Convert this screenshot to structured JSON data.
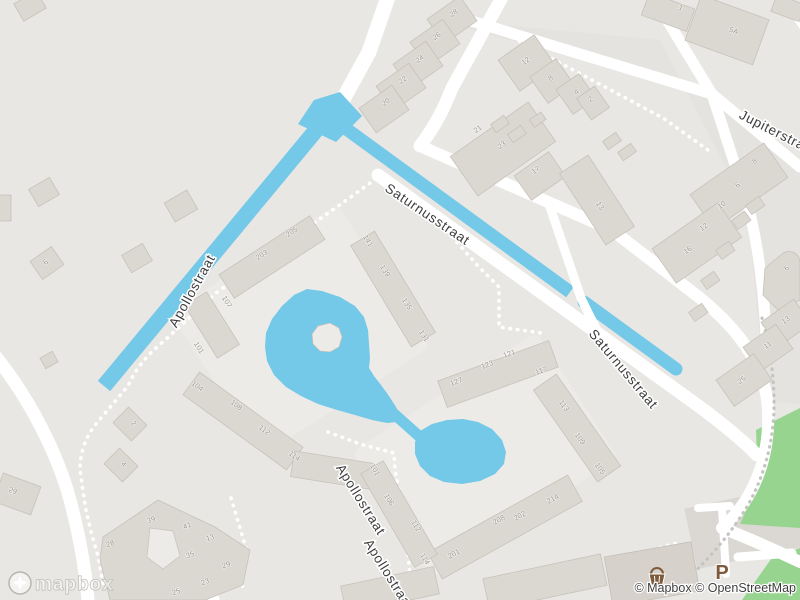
{
  "map": {
    "street_labels": [
      {
        "text": "Saturnusstraat",
        "x": 425,
        "y": 218,
        "r": 34
      },
      {
        "text": "Saturnusstraat",
        "x": 620,
        "y": 372,
        "r": 50
      },
      {
        "text": "Jupiterstraat",
        "x": 776,
        "y": 137,
        "r": 27
      },
      {
        "text": "Apollostraat",
        "x": 196,
        "y": 293,
        "r": -61
      },
      {
        "text": "Apollostraat",
        "x": 357,
        "y": 502,
        "r": 58
      },
      {
        "text": "Apollostraat",
        "x": 385,
        "y": 577,
        "r": 58
      }
    ],
    "house_numbers": [
      {
        "t": "28",
        "x": 455,
        "y": 15,
        "r": -35
      },
      {
        "t": "26",
        "x": 438,
        "y": 38,
        "r": -35
      },
      {
        "t": "24",
        "x": 421,
        "y": 61,
        "r": -35
      },
      {
        "t": "22",
        "x": 404,
        "y": 82,
        "r": -35
      },
      {
        "t": "20",
        "x": 387,
        "y": 104,
        "r": -35
      },
      {
        "t": "12",
        "x": 527,
        "y": 63,
        "r": -35
      },
      {
        "t": "8",
        "x": 552,
        "y": 80,
        "r": -35
      },
      {
        "t": "4",
        "x": 578,
        "y": 94,
        "r": -35
      },
      {
        "t": "2",
        "x": 592,
        "y": 101,
        "r": -35
      },
      {
        "t": "21",
        "x": 479,
        "y": 131,
        "r": -35
      },
      {
        "t": "23",
        "x": 503,
        "y": 147,
        "r": -35
      },
      {
        "t": "17",
        "x": 537,
        "y": 172,
        "r": -35
      },
      {
        "t": "1",
        "x": 680,
        "y": 10,
        "r": 20
      },
      {
        "t": "5A",
        "x": 733,
        "y": 33,
        "r": 20
      },
      {
        "t": "8",
        "x": 756,
        "y": 163,
        "r": -35
      },
      {
        "t": "6",
        "x": 739,
        "y": 187,
        "r": -35
      },
      {
        "t": "10",
        "x": 723,
        "y": 207,
        "r": -35
      },
      {
        "t": "12",
        "x": 705,
        "y": 229,
        "r": -35
      },
      {
        "t": "16",
        "x": 689,
        "y": 252,
        "r": -35
      },
      {
        "t": "6",
        "x": 788,
        "y": 270,
        "r": -35
      },
      {
        "t": "13",
        "x": 787,
        "y": 322,
        "r": -35
      },
      {
        "t": "11",
        "x": 769,
        "y": 347,
        "r": -35
      },
      {
        "t": "25",
        "x": 743,
        "y": 382,
        "r": -35
      },
      {
        "t": "13",
        "x": 598,
        "y": 207,
        "r": 57
      },
      {
        "t": "203",
        "x": 263,
        "y": 257,
        "r": -33
      },
      {
        "t": "205",
        "x": 293,
        "y": 234,
        "r": -33
      },
      {
        "t": "141",
        "x": 366,
        "y": 242,
        "r": 59
      },
      {
        "t": "139",
        "x": 383,
        "y": 272,
        "r": 59
      },
      {
        "t": "135",
        "x": 405,
        "y": 305,
        "r": 59
      },
      {
        "t": "131",
        "x": 422,
        "y": 337,
        "r": 59
      },
      {
        "t": "107",
        "x": 225,
        "y": 303,
        "r": 58
      },
      {
        "t": "101",
        "x": 197,
        "y": 349,
        "r": 58
      },
      {
        "t": "104",
        "x": 196,
        "y": 388,
        "r": 36
      },
      {
        "t": "108",
        "x": 235,
        "y": 407,
        "r": 36
      },
      {
        "t": "112",
        "x": 263,
        "y": 432,
        "r": 36
      },
      {
        "t": "114",
        "x": 293,
        "y": 458,
        "r": 36
      },
      {
        "t": "127",
        "x": 457,
        "y": 384,
        "r": -20
      },
      {
        "t": "123",
        "x": 488,
        "y": 367,
        "r": -20
      },
      {
        "t": "121",
        "x": 510,
        "y": 356,
        "r": -20
      },
      {
        "t": "117",
        "x": 542,
        "y": 373,
        "r": -20
      },
      {
        "t": "113",
        "x": 562,
        "y": 407,
        "r": 55
      },
      {
        "t": "109",
        "x": 578,
        "y": 440,
        "r": 55
      },
      {
        "t": "105",
        "x": 598,
        "y": 470,
        "r": 55
      },
      {
        "t": "101",
        "x": 373,
        "y": 471,
        "r": 60
      },
      {
        "t": "106",
        "x": 387,
        "y": 501,
        "r": 60
      },
      {
        "t": "112",
        "x": 414,
        "y": 527,
        "r": 60
      },
      {
        "t": "114",
        "x": 423,
        "y": 560,
        "r": 60
      },
      {
        "t": "201",
        "x": 455,
        "y": 556,
        "r": -29
      },
      {
        "t": "208",
        "x": 500,
        "y": 522,
        "r": -29
      },
      {
        "t": "202",
        "x": 521,
        "y": 518,
        "r": -29
      },
      {
        "t": "214",
        "x": 554,
        "y": 501,
        "r": -29
      },
      {
        "t": "39",
        "x": 152,
        "y": 522,
        "r": -20
      },
      {
        "t": "41",
        "x": 188,
        "y": 528,
        "r": -20
      },
      {
        "t": "13",
        "x": 211,
        "y": 540,
        "r": -20
      },
      {
        "t": "35",
        "x": 191,
        "y": 557,
        "r": -20
      },
      {
        "t": "29",
        "x": 227,
        "y": 567,
        "r": -20
      },
      {
        "t": "23",
        "x": 206,
        "y": 584,
        "r": -20
      },
      {
        "t": "25",
        "x": 177,
        "y": 594,
        "r": -20
      },
      {
        "t": "28",
        "x": 111,
        "y": 546,
        "r": -20
      },
      {
        "t": "2",
        "x": 132,
        "y": 425,
        "r": 45
      },
      {
        "t": "4",
        "x": 122,
        "y": 466,
        "r": 45
      },
      {
        "t": "29",
        "x": 12,
        "y": 493,
        "r": 20
      },
      {
        "t": "6",
        "x": 47,
        "y": 264,
        "r": -35
      }
    ],
    "poi": {
      "parking_label": "P",
      "shop_icon": "basket-icon"
    },
    "logo_text": "mapbox",
    "attribution": "© Mapbox © OpenStreetMap",
    "colors": {
      "background": "#e8e7e3",
      "water": "#74c8e8",
      "road": "#ffffff",
      "building": "#dbd7d1",
      "building_outline": "#c7c2bb",
      "park": "#96d48f",
      "label": "#3c3c3c",
      "house_number": "#9d978e",
      "poi_brown": "#7d5a3c",
      "sidewalk_dots": "#c6c4c0",
      "block_tint": "#e5e3df",
      "courtyard": "#edebe7"
    }
  }
}
